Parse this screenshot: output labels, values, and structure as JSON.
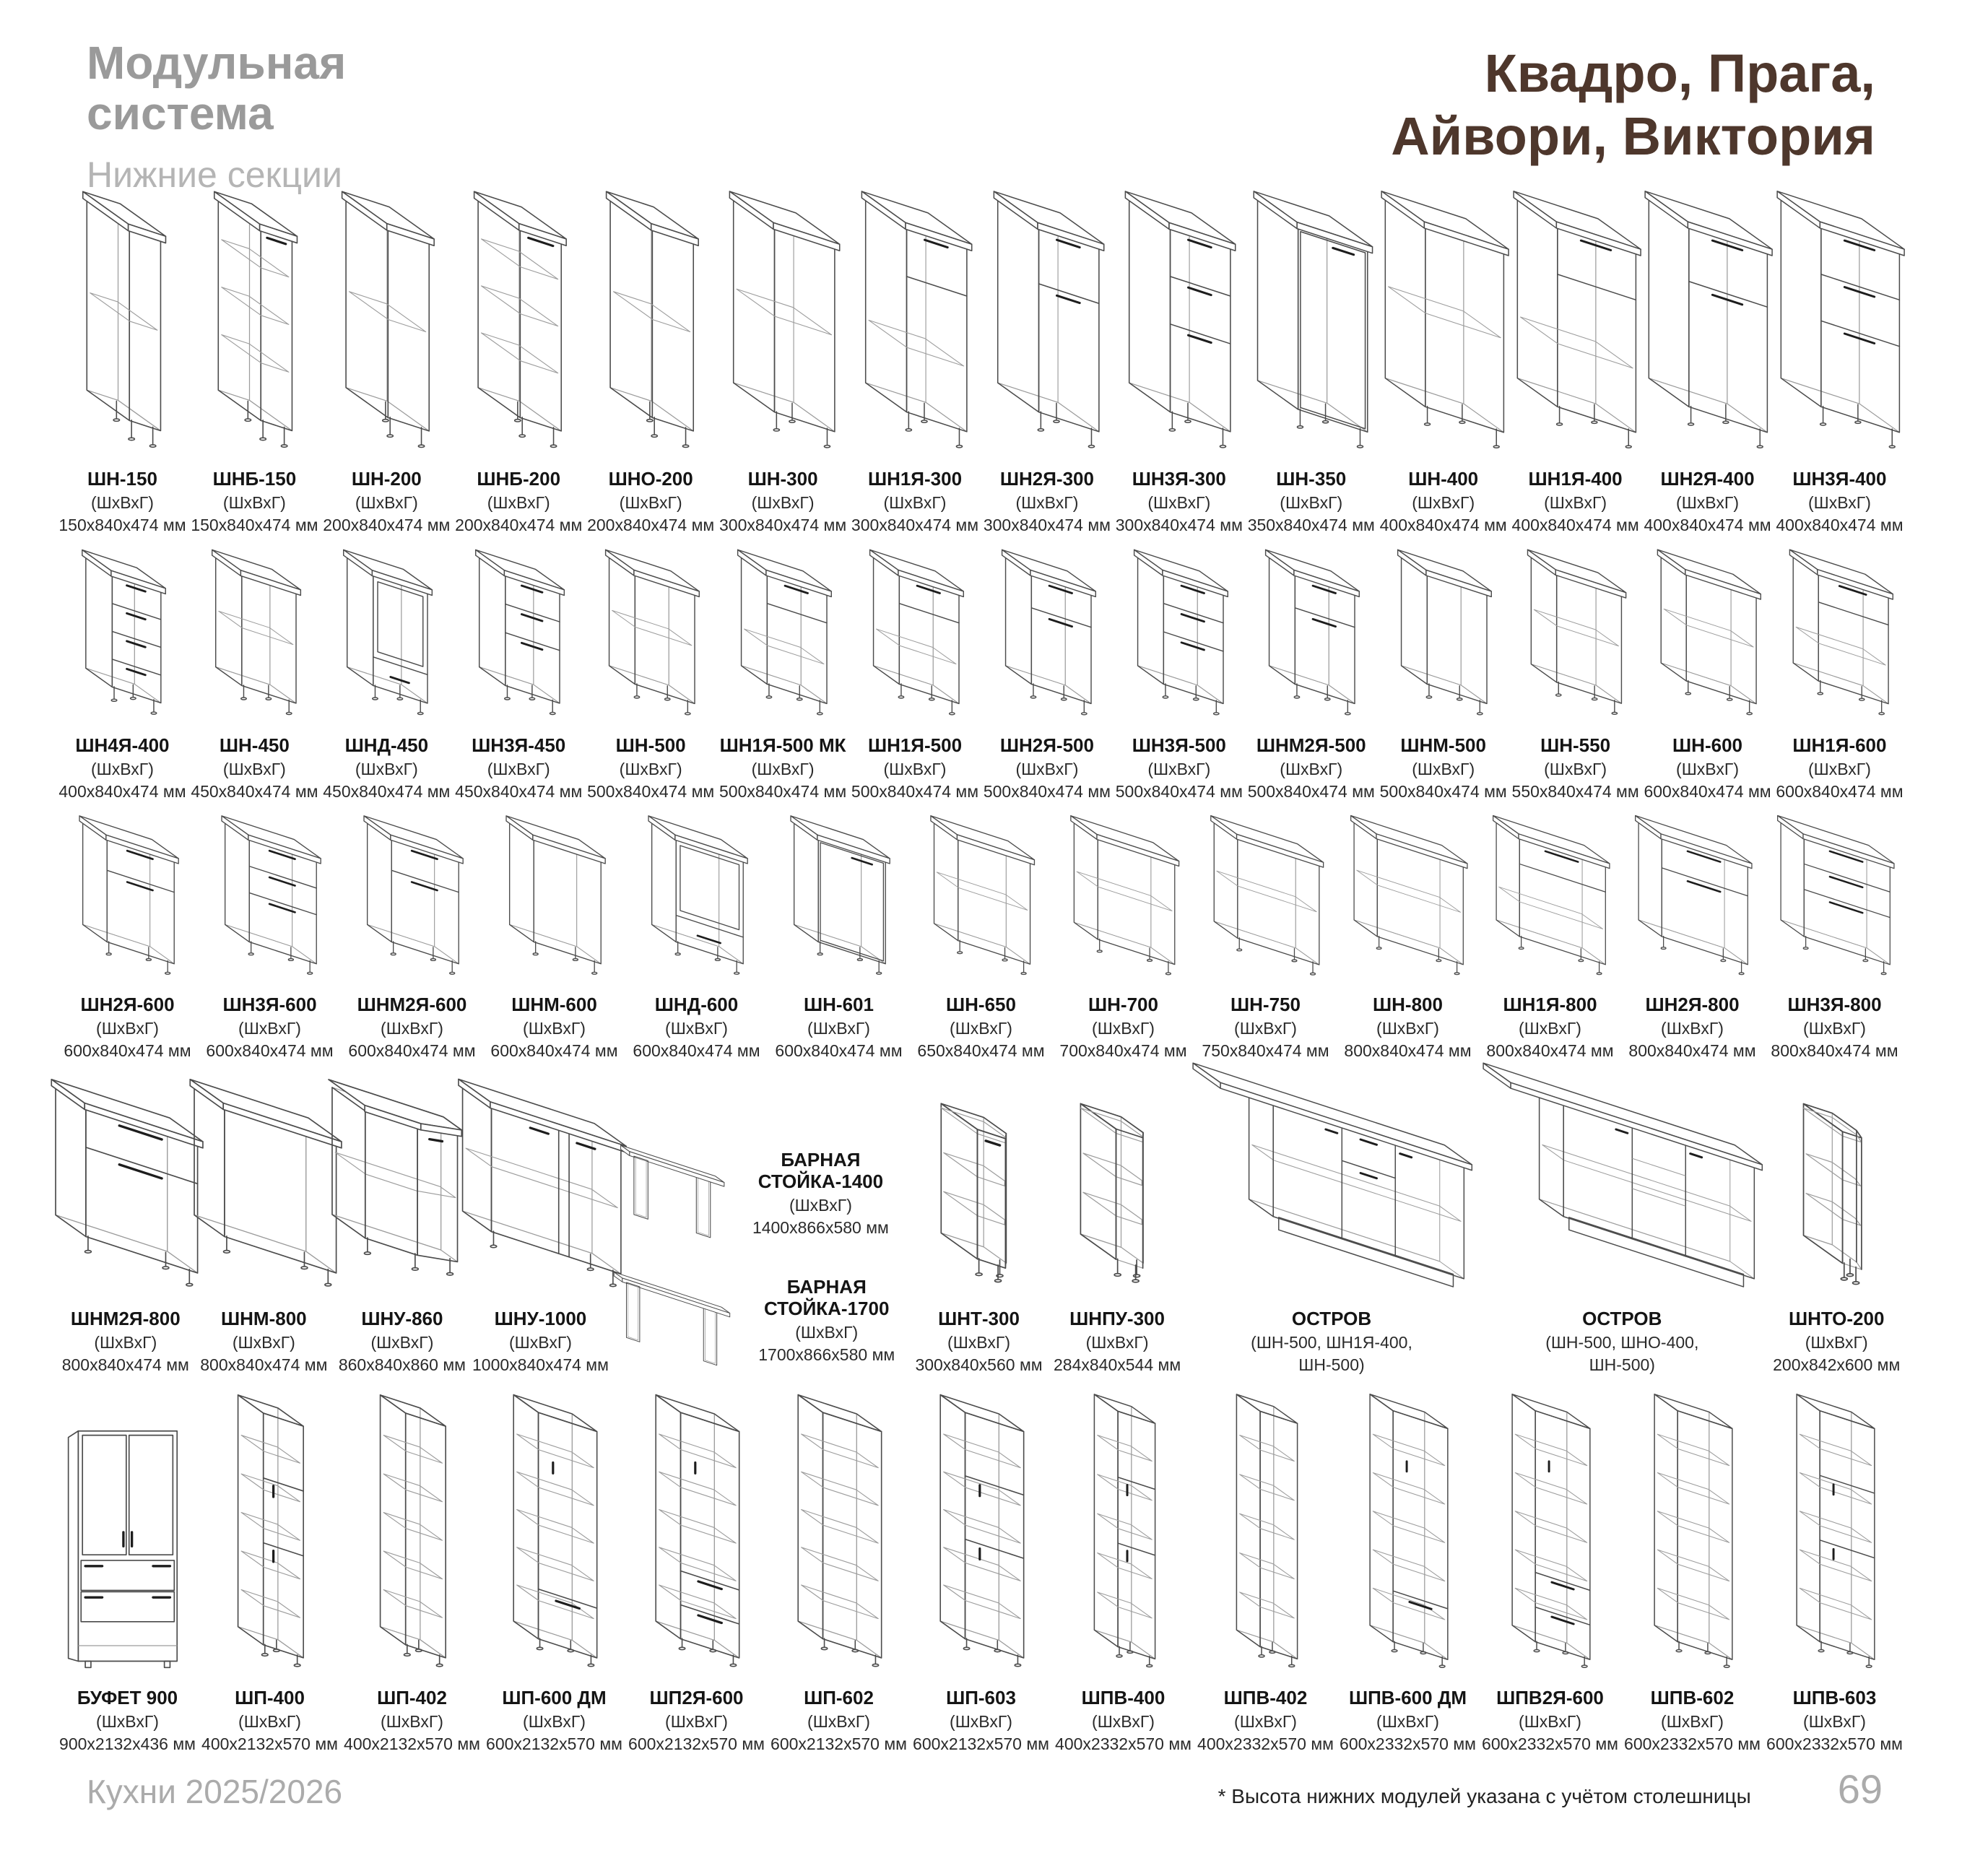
{
  "header": {
    "title_line1": "Модульная",
    "title_line2": "система",
    "subtitle": "Нижние секции",
    "collections_line1": "Квадро, Прага,",
    "collections_line2": "Айвори, Виктория"
  },
  "colors": {
    "accent_brown": "#4e372c",
    "muted_gray": "#9a9a9a",
    "line": "#4b4b4b"
  },
  "dims_caption": "(ШхВхГ)",
  "rows": [
    {
      "items": [
        {
          "name": "ШН-150",
          "l2": "(ШхВхГ)",
          "l3": "150х840х474 мм",
          "drawing": "open"
        },
        {
          "name": "ШНБ-150",
          "l2": "(ШхВхГ)",
          "l3": "150х840х474 мм",
          "drawing": "bottle-rack"
        },
        {
          "name": "ШН-200",
          "l2": "(ШхВхГ)",
          "l3": "200х840х474 мм",
          "drawing": "open"
        },
        {
          "name": "ШНБ-200",
          "l2": "(ШхВхГ)",
          "l3": "200х840х474 мм",
          "drawing": "bottle-rack"
        },
        {
          "name": "ШНО-200",
          "l2": "(ШхВхГ)",
          "l3": "200х840х474 мм",
          "drawing": "open"
        },
        {
          "name": "ШН-300",
          "l2": "(ШхВхГ)",
          "l3": "300х840х474 мм",
          "drawing": "open"
        },
        {
          "name": "ШН1Я-300",
          "l2": "(ШхВхГ)",
          "l3": "300х840х474 мм",
          "drawing": "drawer-1"
        },
        {
          "name": "ШН2Я-300",
          "l2": "(ШхВхГ)",
          "l3": "300х840х474 мм",
          "drawing": "drawer-2"
        },
        {
          "name": "ШН3Я-300",
          "l2": "(ШхВхГ)",
          "l3": "300х840х474 мм",
          "drawing": "drawer-3"
        },
        {
          "name": "ШН-350",
          "l2": "(ШхВхГ)",
          "l3": "350х840х474 мм",
          "drawing": "door"
        },
        {
          "name": "ШН-400",
          "l2": "(ШхВхГ)",
          "l3": "400х840х474 мм",
          "drawing": "open"
        },
        {
          "name": "ШН1Я-400",
          "l2": "(ШхВхГ)",
          "l3": "400х840х474 мм",
          "drawing": "drawer-1"
        },
        {
          "name": "ШН2Я-400",
          "l2": "(ШхВхГ)",
          "l3": "400х840х474 мм",
          "drawing": "drawer-2"
        },
        {
          "name": "ШН3Я-400",
          "l2": "(ШхВхГ)",
          "l3": "400х840х474 мм",
          "drawing": "drawer-3"
        }
      ]
    },
    {
      "items": [
        {
          "name": "ШН4Я-400",
          "l2": "(ШхВхГ)",
          "l3": "400х840х474 мм",
          "drawing": "drawer-4"
        },
        {
          "name": "ШН-450",
          "l2": "(ШхВхГ)",
          "l3": "450х840х474 мм",
          "drawing": "open"
        },
        {
          "name": "ШНД-450",
          "l2": "(ШхВхГ)",
          "l3": "450х840х474 мм",
          "drawing": "oven"
        },
        {
          "name": "ШН3Я-450",
          "l2": "(ШхВхГ)",
          "l3": "450х840х474 мм",
          "drawing": "drawer-3"
        },
        {
          "name": "ШН-500",
          "l2": "(ШхВхГ)",
          "l3": "500х840х474 мм",
          "drawing": "open"
        },
        {
          "name": "ШН1Я-500 МК",
          "l2": "(ШхВхГ)",
          "l3": "500х840х474 мм",
          "drawing": "drawer-1"
        },
        {
          "name": "ШН1Я-500",
          "l2": "(ШхВхГ)",
          "l3": "500х840х474 мм",
          "drawing": "drawer-1"
        },
        {
          "name": "ШН2Я-500",
          "l2": "(ШхВхГ)",
          "l3": "500х840х474 мм",
          "drawing": "drawer-2"
        },
        {
          "name": "ШН3Я-500",
          "l2": "(ШхВхГ)",
          "l3": "500х840х474 мм",
          "drawing": "drawer-3"
        },
        {
          "name": "ШНМ2Я-500",
          "l2": "(ШхВхГ)",
          "l3": "500х840х474 мм",
          "drawing": "drawer-2"
        },
        {
          "name": "ШНМ-500",
          "l2": "(ШхВхГ)",
          "l3": "500х840х474 мм",
          "drawing": "no-shelf"
        },
        {
          "name": "ШН-550",
          "l2": "(ШхВхГ)",
          "l3": "550х840х474 мм",
          "drawing": "open"
        },
        {
          "name": "ШН-600",
          "l2": "(ШхВхГ)",
          "l3": "600х840х474 мм",
          "drawing": "open"
        },
        {
          "name": "ШН1Я-600",
          "l2": "(ШхВхГ)",
          "l3": "600х840х474 мм",
          "drawing": "drawer-1"
        }
      ]
    },
    {
      "items": [
        {
          "name": "ШН2Я-600",
          "l2": "(ШхВхГ)",
          "l3": "600х840х474 мм",
          "drawing": "drawer-2"
        },
        {
          "name": "ШН3Я-600",
          "l2": "(ШхВхГ)",
          "l3": "600х840х474 мм",
          "drawing": "drawer-3"
        },
        {
          "name": "ШНМ2Я-600",
          "l2": "(ШхВхГ)",
          "l3": "600х840х474 мм",
          "drawing": "drawer-2"
        },
        {
          "name": "ШНМ-600",
          "l2": "(ШхВхГ)",
          "l3": "600х840х474 мм",
          "drawing": "no-shelf"
        },
        {
          "name": "ШНД-600",
          "l2": "(ШхВхГ)",
          "l3": "600х840х474 мм",
          "drawing": "oven"
        },
        {
          "name": "ШН-601",
          "l2": "(ШхВхГ)",
          "l3": "600х840х474 мм",
          "drawing": "door"
        },
        {
          "name": "ШН-650",
          "l2": "(ШхВхГ)",
          "l3": "650х840х474 мм",
          "drawing": "open"
        },
        {
          "name": "ШН-700",
          "l2": "(ШхВхГ)",
          "l3": "700х840х474 мм",
          "drawing": "open"
        },
        {
          "name": "ШН-750",
          "l2": "(ШхВхГ)",
          "l3": "750х840х474 мм",
          "drawing": "open"
        },
        {
          "name": "ШН-800",
          "l2": "(ШхВхГ)",
          "l3": "800х840х474 мм",
          "drawing": "open"
        },
        {
          "name": "ШН1Я-800",
          "l2": "(ШхВхГ)",
          "l3": "800х840х474 мм",
          "drawing": "drawer-1"
        },
        {
          "name": "ШН2Я-800",
          "l2": "(ШхВхГ)",
          "l3": "800х840х474 мм",
          "drawing": "drawer-2"
        },
        {
          "name": "ШН3Я-800",
          "l2": "(ШхВхГ)",
          "l3": "800х840х474 мм",
          "drawing": "drawer-3"
        }
      ]
    },
    {
      "items": [
        {
          "name": "ШНМ2Я-800",
          "l2": "(ШхВхГ)",
          "l3": "800х840х474 мм",
          "drawing": "drawer-2"
        },
        {
          "name": "ШНМ-800",
          "l2": "(ШхВхГ)",
          "l3": "800х840х474 мм",
          "drawing": "no-shelf"
        },
        {
          "name": "ШНУ-860",
          "l2": "(ШхВхГ)",
          "l3": "860х840х860 мм",
          "drawing": "corner-bevel"
        },
        {
          "name": "ШНУ-1000",
          "l2": "(ШхВхГ)",
          "l3": "1000х840х474 мм",
          "drawing": "corner-straight"
        },
        {
          "name": "БАРНАЯ СТОЙКА-1400",
          "l2": "(ШхВхГ)",
          "l3": "1400х866х580 мм",
          "drawing": "bar-stand"
        },
        {
          "name": "БАРНАЯ СТОЙКА-1700",
          "l2": "(ШхВхГ)",
          "l3": "1700х866х580 мм",
          "drawing": "bar-stand"
        },
        {
          "name": "ШНТ-300",
          "l2": "(ШхВхГ)",
          "l3": "300х840х560 мм",
          "drawing": "end-door"
        },
        {
          "name": "ШНПУ-300",
          "l2": "(ШхВхГ)",
          "l3": "284х840х544 мм",
          "drawing": "end-open"
        },
        {
          "name": "ОСТРОВ",
          "l2": "(ШН-500, ШН1Я-400,",
          "l3": "ШН-500)",
          "drawing": "island-drawer"
        },
        {
          "name": "ОСТРОВ",
          "l2": "(ШН-500, ШНО-400,",
          "l3": "ШН-500)",
          "drawing": "island-open"
        },
        {
          "name": "ШНТО-200",
          "l2": "(ШхВхГ)",
          "l3": "200х842х600 мм",
          "drawing": "end-open"
        }
      ]
    },
    {
      "items": [
        {
          "name": "БУФЕТ 900",
          "l2": "(ШхВхГ)",
          "l3": "900х2132х436 мм",
          "drawing": "buffet"
        },
        {
          "name": "ШП-400",
          "l2": "(ШхВхГ)",
          "l3": "400х2132х570 мм",
          "drawing": "tall-doors"
        },
        {
          "name": "ШП-402",
          "l2": "(ШхВхГ)",
          "l3": "400х2132х570 мм",
          "drawing": "tall-open"
        },
        {
          "name": "ШП-600 ДМ",
          "l2": "(ШхВхГ)",
          "l3": "600х2132х570 мм",
          "drawing": "tall-drawer"
        },
        {
          "name": "ШП2Я-600",
          "l2": "(ШхВхГ)",
          "l3": "600х2132х570 мм",
          "drawing": "tall-2drawers"
        },
        {
          "name": "ШП-602",
          "l2": "(ШхВхГ)",
          "l3": "600х2132х570 мм",
          "drawing": "tall-open"
        },
        {
          "name": "ШП-603",
          "l2": "(ШхВхГ)",
          "l3": "600х2132х570 мм",
          "drawing": "tall-doors"
        },
        {
          "name": "ШПВ-400",
          "l2": "(ШхВхГ)",
          "l3": "400х2332х570 мм",
          "drawing": "tall-doors"
        },
        {
          "name": "ШПВ-402",
          "l2": "(ШхВхГ)",
          "l3": "400х2332х570 мм",
          "drawing": "tall-open"
        },
        {
          "name": "ШПВ-600 ДМ",
          "l2": "(ШхВхГ)",
          "l3": "600х2332х570 мм",
          "drawing": "tall-drawer"
        },
        {
          "name": "ШПВ2Я-600",
          "l2": "(ШхВхГ)",
          "l3": "600х2332х570 мм",
          "drawing": "tall-2drawers"
        },
        {
          "name": "ШПВ-602",
          "l2": "(ШхВхГ)",
          "l3": "600х2332х570 мм",
          "drawing": "tall-open"
        },
        {
          "name": "ШПВ-603",
          "l2": "(ШхВхГ)",
          "l3": "600х2332х570 мм",
          "drawing": "tall-doors"
        }
      ]
    }
  ],
  "footer": {
    "brand": "Кухни  2025/2026",
    "note": "* Высота нижних модулей указана с учётом столешницы",
    "page": "69"
  }
}
